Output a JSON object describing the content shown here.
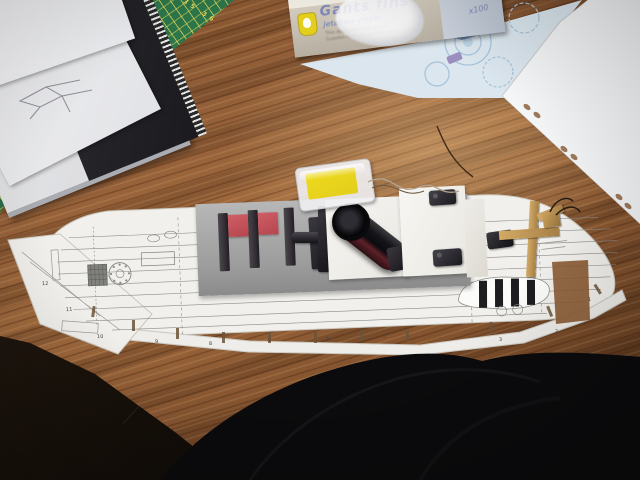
{
  "glove_box": {
    "brand": "Gants fins",
    "subtitle": "jetables vinyle",
    "desc_line1": "Thin disposable vinyl gloves",
    "desc_line2": "Guantes finos desechables vinilo",
    "count_label": "x100"
  },
  "cutting_mat": {
    "scale_numbers": "34 35 36"
  },
  "ship_plan": {
    "tab_numbers": [
      "12",
      "11",
      "10",
      "9",
      "8",
      "7",
      "6",
      "5",
      "3",
      "2",
      "1"
    ]
  },
  "icons": {
    "thumbs_up_logo": "thumbs-up-logo",
    "gloved_hands": "gloved-hands-illustration",
    "punch_holes": "punch-holes"
  },
  "colors": {
    "wood_base": "#95613a",
    "wood_dark": "#5a381e",
    "mat_green": "#2e7b4c",
    "mat_grid_yellow": "#e8d85a",
    "deck_gray": "#a6a6a6",
    "hatch_red": "#b6454e",
    "part_black": "#1a191d",
    "gun_maroon": "#5e2129",
    "paper_white": "#f1f0ec",
    "plan_line_gray": "#8b8b8b",
    "blueprint_bg": "#dce7ef",
    "blueprint_line": "#9fbdd8",
    "brand_blue": "#7e88b4",
    "blister_yellow": "#e3cf1b",
    "crane_tan": "#c09a5c",
    "fabric_black": "#0b0b0d",
    "wire_brown": "#3f2a16"
  }
}
